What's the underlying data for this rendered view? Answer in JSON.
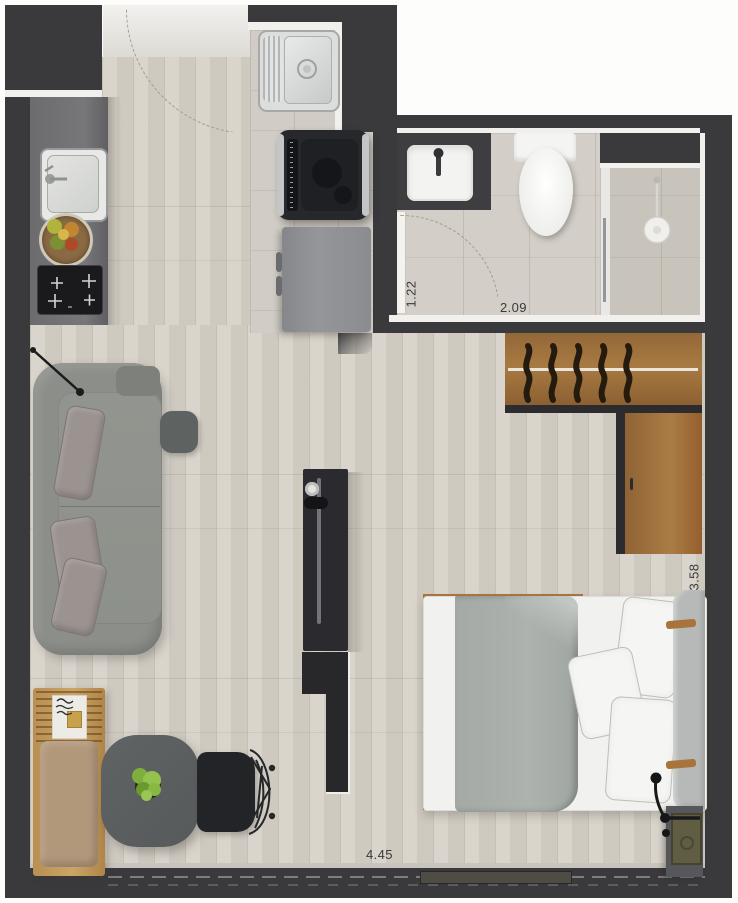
{
  "plan": {
    "type": "studio-apartment-floor-plan",
    "dimension_labels": {
      "bath_entry": "1.22",
      "bathroom": "2.09",
      "bedroom": "3.58",
      "living": "4.45"
    },
    "rooms": [
      "entry",
      "kitchen",
      "laundry-nook",
      "bathroom",
      "wardrobe",
      "sleeping-area",
      "living-area",
      "dining-area",
      "window-wall"
    ],
    "fixtures": [
      "kitchen-sink",
      "cooktop",
      "fruit-bowl",
      "laundry-sink",
      "washing-machine",
      "refrigerator",
      "vanity-sink",
      "toilet",
      "shower",
      "shower-glass-partition",
      "wardrobe-hangers",
      "double-bed",
      "pillows",
      "headboard",
      "nightstand",
      "reading-lamp",
      "sofa",
      "sofa-cushions",
      "side-table",
      "tv-console",
      "room-divider",
      "dining-table",
      "potted-plant",
      "wire-chair",
      "bench-daybed",
      "floor-lamp",
      "entry-door-swing",
      "bathroom-door-swing"
    ],
    "colors": {
      "wall": "#3a3a3c",
      "wall_face": "#f1f0ed",
      "floor_plank": "#d6d1c8",
      "floor_tile": "#d1cdc6",
      "wardrobe_wood": "#a0703c",
      "sofa_gray": "#8b8e89",
      "blanket_gray": "#a9aeab",
      "table_gray": "#5b5f60",
      "plant_green": "#86b23f",
      "label_text": "#3a3a3a"
    }
  }
}
